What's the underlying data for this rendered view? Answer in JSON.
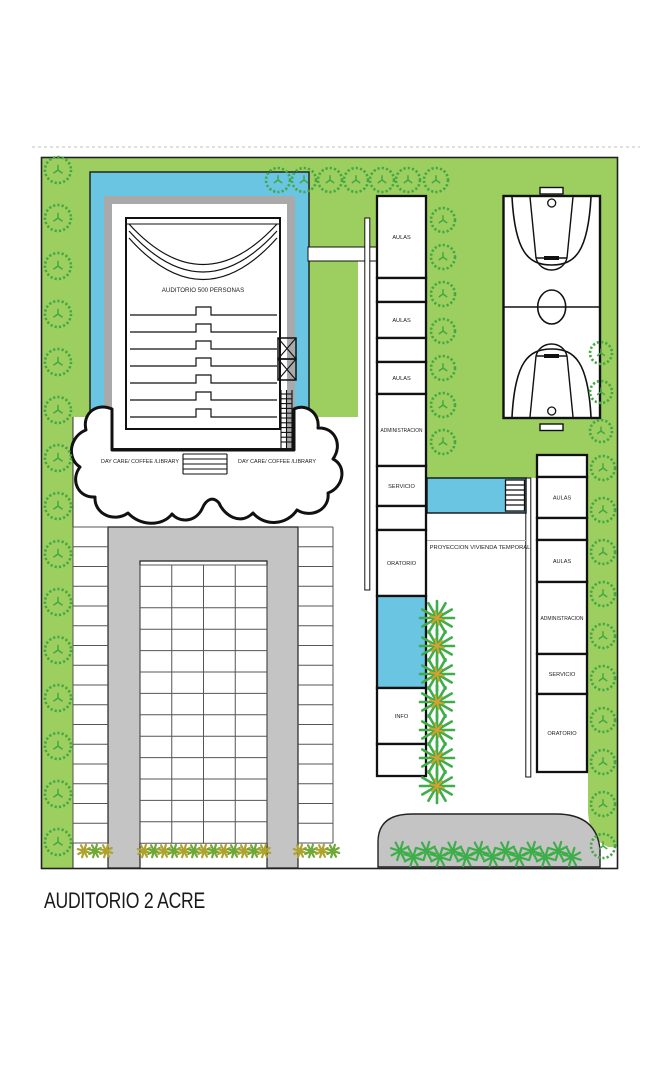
{
  "title": "AUDITORIO 2 ACRE",
  "plan": {
    "auditorium_label": "AUDITORIO 500 PERSONAS",
    "daycare_label_left": "DAY CARE/ COFFEE /LIBRARY",
    "daycare_label_right": "DAY CARE/ COFFEE /LIBRARY",
    "projection_label": "PROYECCION VIVIENDA TEMPORAL",
    "rooms": {
      "middle_column": [
        "AULAS",
        "",
        "AULAS",
        "",
        "AULAS",
        "ADMINISTRACION",
        "SERVICIO",
        "",
        "ORATORIO",
        "",
        "INFO",
        ""
      ],
      "right_column": [
        "",
        "AULAS",
        "",
        "AULAS",
        "ADMINISTRACION",
        "SERVICIO",
        "ORATORIO"
      ]
    }
  },
  "colors": {
    "lawn_green": "#9CCE60",
    "tree_green": "#43A843",
    "water_blue": "#6AC5E2",
    "road_gray": "#C4C4C4",
    "frame_gray": "#A9A9A9",
    "shrub_olive": "#AFA32F",
    "shrub_green": "#6FA839",
    "palm_green": "#3DAE49",
    "palm_accent": "#D79F2E",
    "line_black": "#1A1A1A"
  }
}
